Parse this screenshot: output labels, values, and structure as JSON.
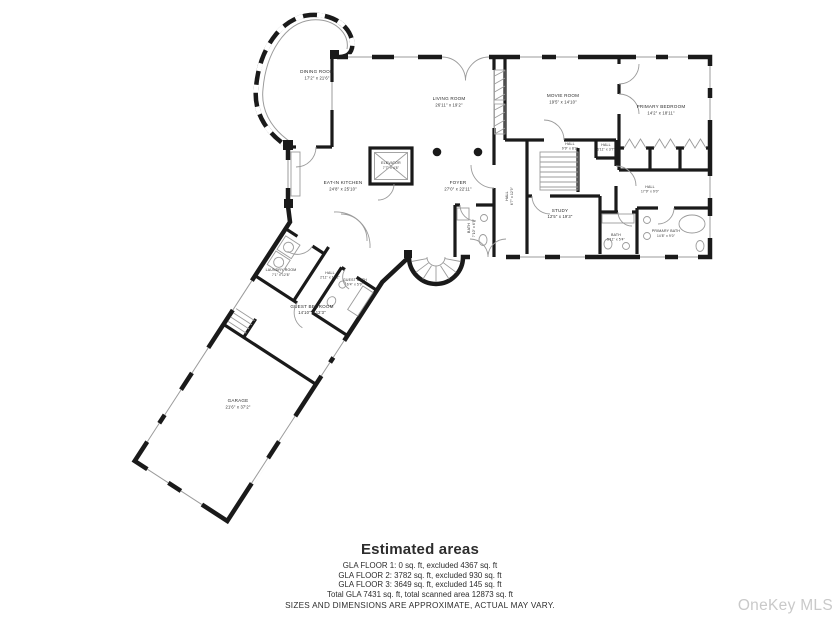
{
  "theme": {
    "wall": "#1a1a1a",
    "fixture": "#9b9b9b",
    "label": "#2b2b2b",
    "watermark": "#c9c9c9"
  },
  "plan": {
    "rooms": [
      {
        "name": "DINING ROOM",
        "dims": "17'2\" x 21'6\""
      },
      {
        "name": "LIVING ROOM",
        "dims": "26'11\" x 19'2\""
      },
      {
        "name": "MOVIE ROOM",
        "dims": "19'5\" x 14'10\""
      },
      {
        "name": "PRIMARY BEDROOM",
        "dims": "14'2\" x 18'11\""
      },
      {
        "name": "ELEVATOR",
        "dims": "7'7\" x 4'8\""
      },
      {
        "name": "FOYER",
        "dims": "27'0\" x 22'11\""
      },
      {
        "name": "EAT-IN KITCHEN",
        "dims": "24'8\" x 25'10\""
      },
      {
        "name": "HALL",
        "dims": "9'9\" x 8'2\""
      },
      {
        "name": "HALL",
        "dims": "6'11\" x 3'7\""
      },
      {
        "name": "HALL",
        "dims": "6'7\" x 12'9\""
      },
      {
        "name": "HALL",
        "dims": "17'9\" x 9'0\""
      },
      {
        "name": "STUDY",
        "dims": "12'5\" x 19'3\""
      },
      {
        "name": "BATH",
        "dims": "7'10\" x 6'9\""
      },
      {
        "name": "BATH",
        "dims": "5'11\" x 5'4\""
      },
      {
        "name": "PRIMARY BATH",
        "dims": "14'8\" x 9'0\""
      },
      {
        "name": "LAUNDRY ROOM",
        "dims": "7'1\" x 12'8\""
      },
      {
        "name": "HALL",
        "dims": "2'11\" x 10'2\""
      },
      {
        "name": "GUEST BATH",
        "dims": "6'4\" x 5'9\""
      },
      {
        "name": "GUEST BEDROOM",
        "dims": "14'10\" x 12'3\""
      },
      {
        "name": "GARAGE",
        "dims": "21'6\" x 37'2\""
      }
    ]
  },
  "estimated_areas": {
    "title": "Estimated areas",
    "lines": [
      "GLA FLOOR 1: 0 sq. ft, excluded 4367 sq. ft",
      "GLA FLOOR 2: 3782 sq. ft, excluded 930 sq. ft",
      "GLA FLOOR 3: 3649 sq. ft, excluded 145 sq. ft",
      "Total GLA 7431 sq. ft, total scanned area 12873 sq. ft"
    ],
    "disclaimer": "SIZES AND DIMENSIONS ARE APPROXIMATE, ACTUAL MAY VARY."
  },
  "watermark_label": "OneKey MLS"
}
